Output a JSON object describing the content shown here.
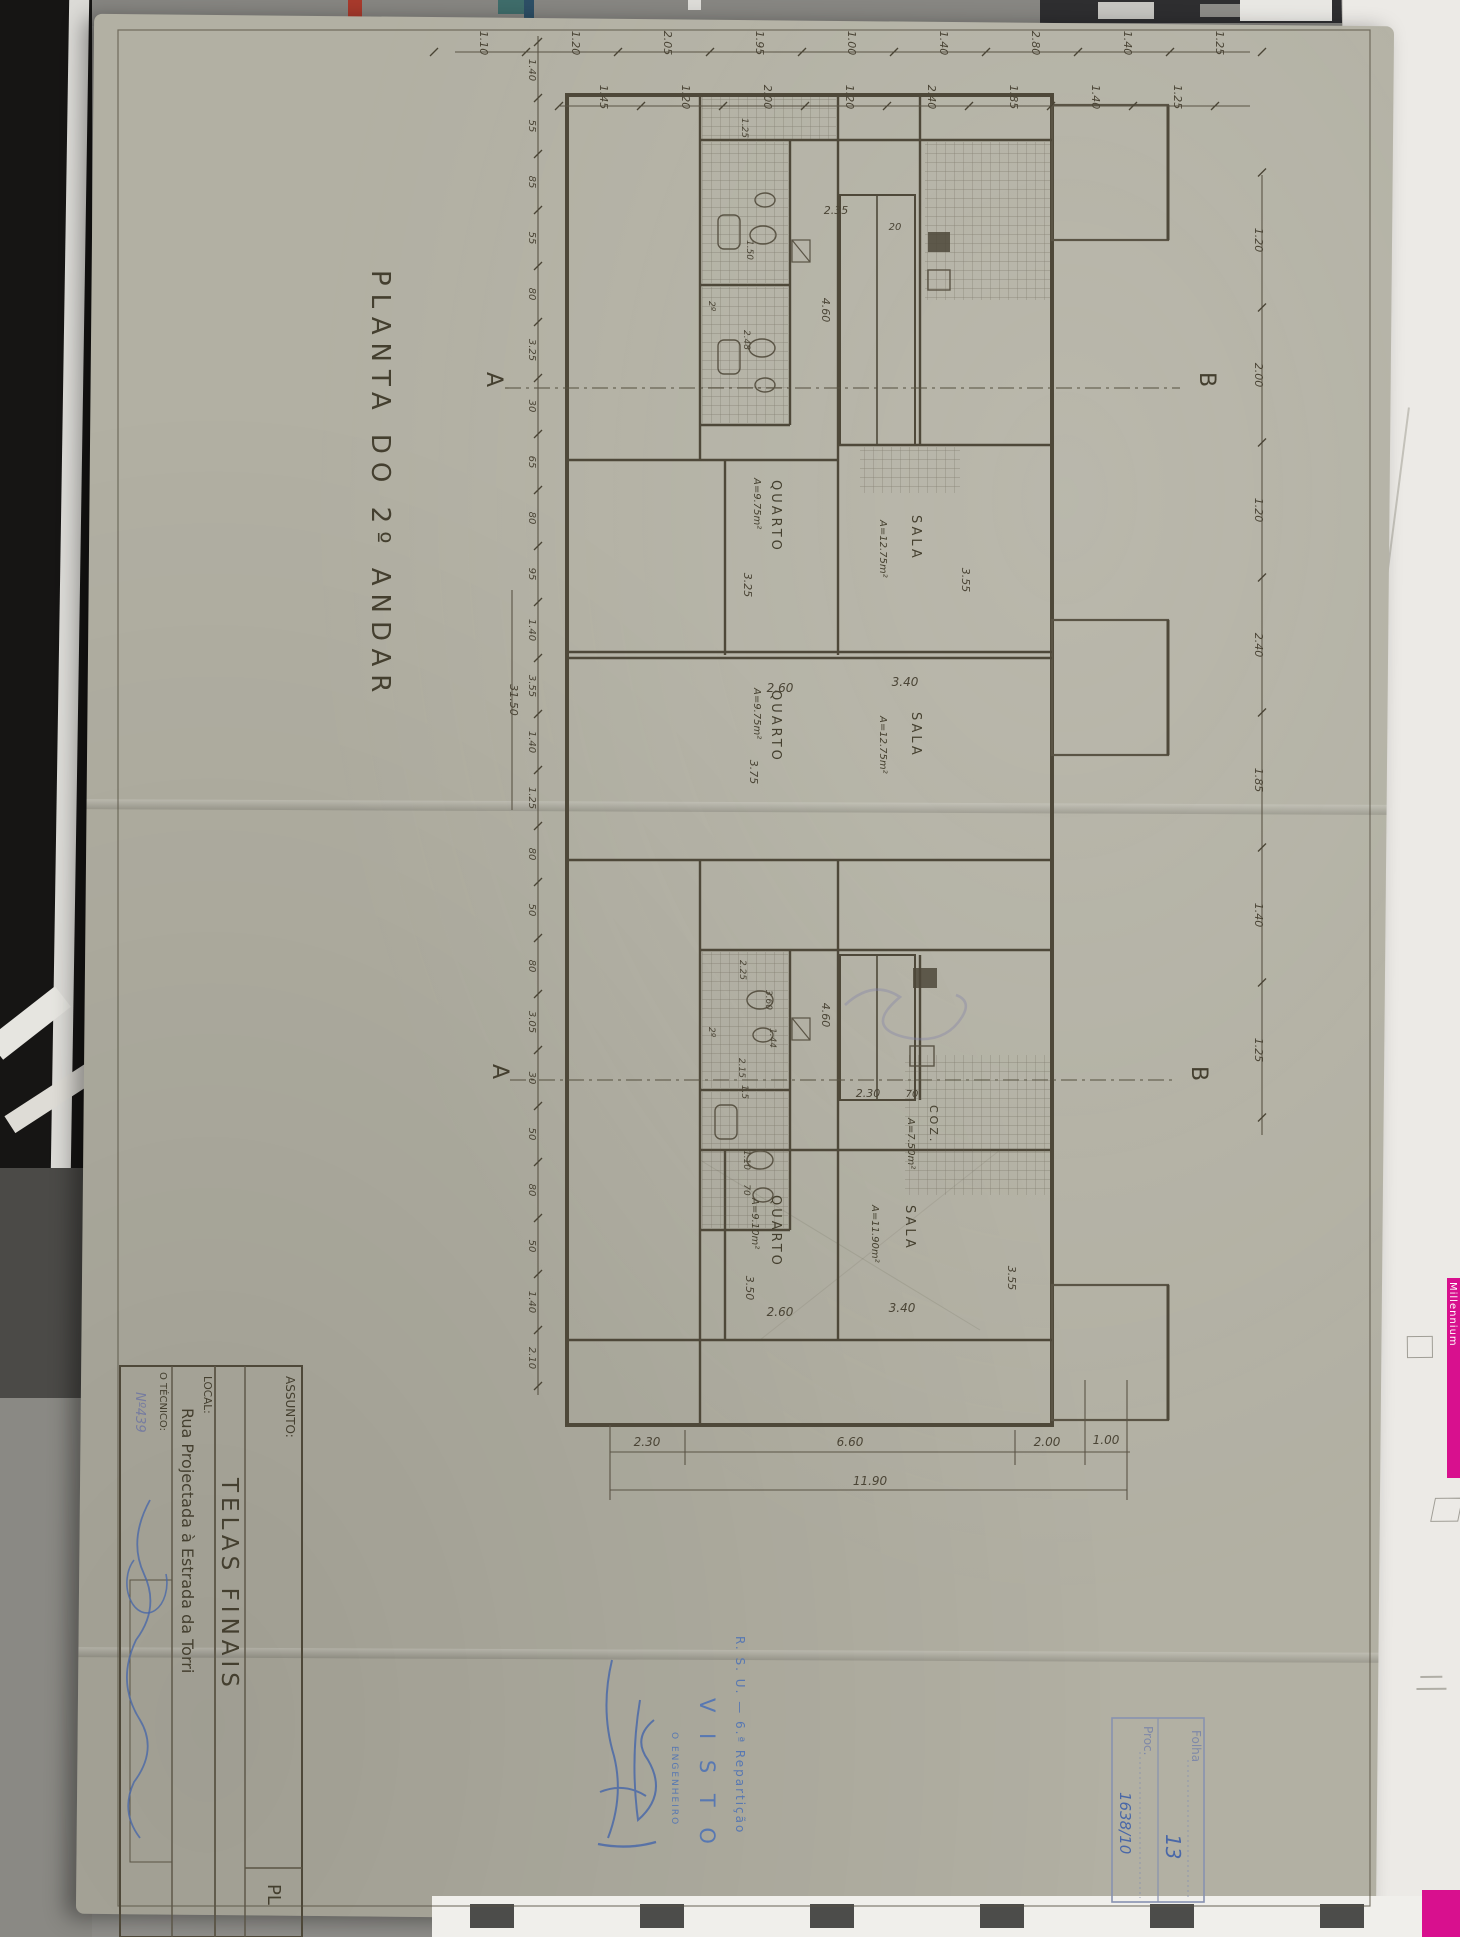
{
  "photo": {
    "paper_color": "#b2b0a3",
    "ink_color": "#4e4839",
    "blue_ink": "#4a68a8",
    "stamp_blue": "#5878b2",
    "magenta": "#d8108e"
  },
  "sheet": {
    "plan_title": "PLANTA  DO  2º  ANDAR"
  },
  "title_block": {
    "assunto_label": "ASSUNTO:",
    "assunto_value": "TELAS  FINAIS",
    "local_label": "LOCAL:",
    "local_value": "Rua  Projectada  à  Estrada  da  Torri",
    "tecnico_label": "O TÉCNICO:",
    "tecnico_number": "Nº439",
    "corner_label": "PL"
  },
  "stamps": {
    "visto_dept": "R. S. U. — 6.ª Repartição",
    "visto_word": "V I S T O",
    "visto_role": "O ENGENHEIRO",
    "folha_label": "Folha",
    "folha_value": "13",
    "proc_label": "Proc.",
    "proc_value": "1638/10"
  },
  "sections": {
    "a": "A",
    "b": "B"
  },
  "rooms": [
    {
      "name": "QUARTO",
      "area": "A=9.75m²"
    },
    {
      "name": "SALA",
      "area": "A=12.75m²"
    },
    {
      "name": "QUARTO",
      "area": "A=9.75m²"
    },
    {
      "name": "SALA",
      "area": "A=12.75m²"
    },
    {
      "name": "QUARTO",
      "area": "A=9.10m²"
    },
    {
      "name": "SALA",
      "area": "A=11.90m²"
    },
    {
      "name": "COZ.",
      "area": "A=7.50m²"
    }
  ],
  "dims": {
    "top_outer": [
      "1.10",
      "1.20",
      "2.05",
      "1.95",
      "1.00",
      "1.40",
      "2.80",
      "1.40",
      "1.25"
    ],
    "top_inner": [
      "1.45",
      "1.20",
      "2.00",
      "1.20",
      "2.40",
      "1.85",
      "1.40",
      "1.25"
    ],
    "left": [
      "1.40",
      "55",
      "85",
      "55",
      "80",
      "3.25",
      "30",
      "65",
      "80",
      "95",
      "1.40",
      "3.55",
      "1.40",
      "1.25",
      "80",
      "50",
      "80",
      "3.05",
      "30",
      "50",
      "80",
      "50",
      "1.40",
      "2.10"
    ],
    "right": [
      "1.20",
      "2.00",
      "1.20",
      "2.40",
      "1.85",
      "1.40",
      "1.25"
    ],
    "left_overall": "31.50",
    "bottom": {
      "s1": "2.30",
      "s2": "6.60",
      "s3": "2.00",
      "s4": "1.00",
      "overall": "11.90"
    },
    "stairs": {
      "landing": "2.35",
      "step": "20",
      "well_upper": "4.60",
      "well_lower": "4.60",
      "lower_width": "2.30",
      "lower_wall": "70"
    },
    "room_dims": {
      "q2_w": "2.60",
      "s2_w": "3.40",
      "q3_w": "2.60",
      "s3_w": "3.40",
      "q1_d": "3.25",
      "s1_d": "3.55",
      "q2_d": "3.75",
      "q3_d": "3.50",
      "s3_d": "3.55"
    },
    "bath": {
      "b1": "1.25",
      "b2": "1.50",
      "b3": "2.48",
      "b4": "2.25",
      "b5": "3.60",
      "b6": "1.44",
      "b7": "2.15",
      "b8": "1.5",
      "hall_w": "1.10",
      "hall_t": "70"
    },
    "vent": "2º"
  },
  "surroundings": {
    "millennium": "Millennium"
  }
}
